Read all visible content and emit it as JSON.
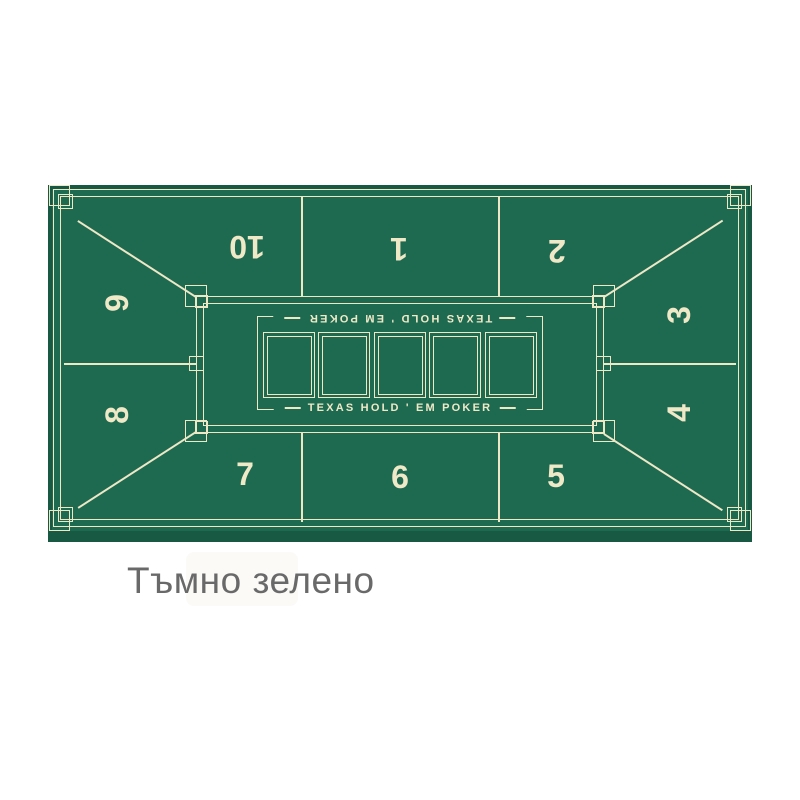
{
  "caption": {
    "text": "Тъмно зелено",
    "color": "#696969"
  },
  "mat": {
    "brand_top": "TEXAS HOLD ' EM POKER",
    "brand_bottom": "TEXAS HOLD ' EM POKER",
    "card_slots": 5,
    "colors": {
      "felt": "#1e6a51",
      "lines": "#eee8c7",
      "edge_band": "#185943",
      "background": "#ffffff"
    },
    "seats": [
      {
        "label": "10"
      },
      {
        "label": "1"
      },
      {
        "label": "2"
      },
      {
        "label": "3"
      },
      {
        "label": "4"
      },
      {
        "label": "5"
      },
      {
        "label": "6"
      },
      {
        "label": "7"
      },
      {
        "label": "8"
      },
      {
        "label": "9"
      }
    ]
  }
}
